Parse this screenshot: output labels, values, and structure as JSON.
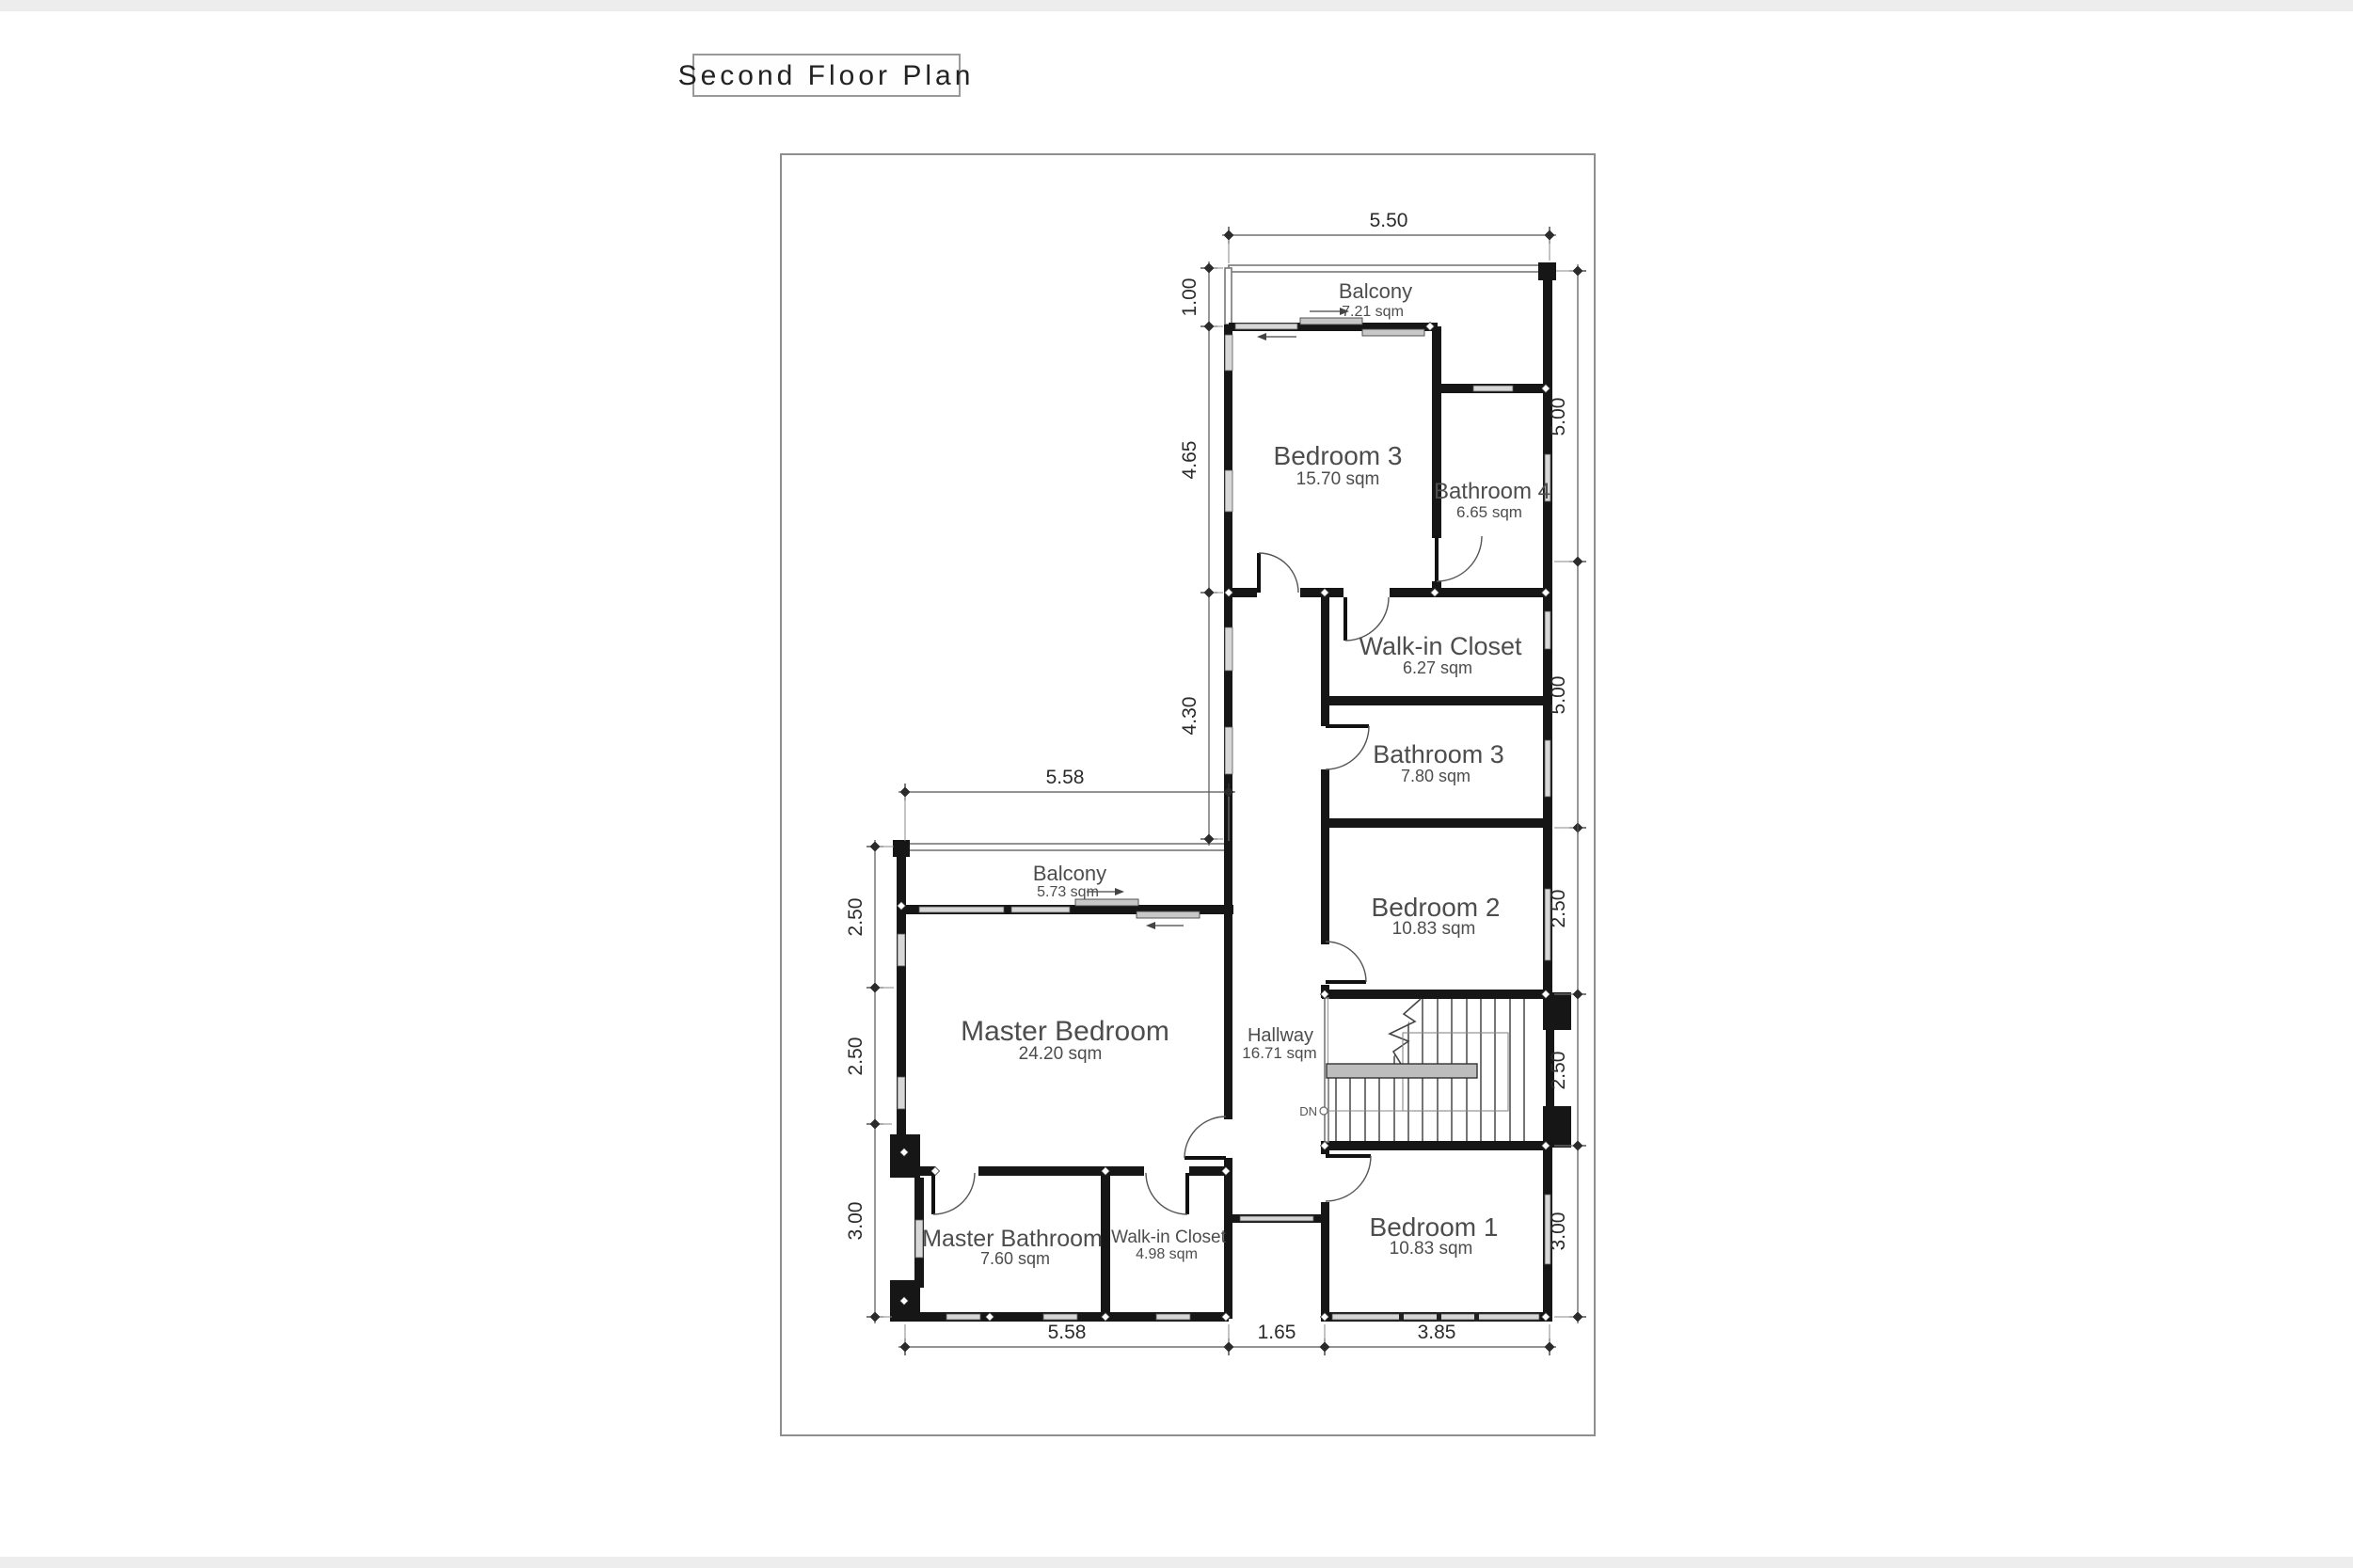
{
  "title": "Second Floor Plan",
  "rooms": {
    "balcony_upper": {
      "name": "Balcony",
      "area": "7.21 sqm"
    },
    "bedroom3": {
      "name": "Bedroom 3",
      "area": "15.70 sqm"
    },
    "bathroom4": {
      "name": "Bathroom 4",
      "area": "6.65 sqm"
    },
    "walkin_closet_upper": {
      "name": "Walk-in Closet",
      "area": "6.27 sqm"
    },
    "bathroom3": {
      "name": "Bathroom 3",
      "area": "7.80 sqm"
    },
    "bedroom2": {
      "name": "Bedroom 2",
      "area": "10.83 sqm"
    },
    "balcony_master": {
      "name": "Balcony",
      "area": "5.73 sqm"
    },
    "master_bedroom": {
      "name": "Master Bedroom",
      "area": "24.20 sqm"
    },
    "hallway": {
      "name": "Hallway",
      "area": "16.71 sqm"
    },
    "master_bathroom": {
      "name": "Master Bathroom",
      "area": "7.60 sqm"
    },
    "walkin_closet_lower": {
      "name": "Walk-in Closet",
      "area": "4.98 sqm"
    },
    "bedroom1": {
      "name": "Bedroom 1",
      "area": "10.83 sqm"
    }
  },
  "dimensions": {
    "top_width": "5.50",
    "upper_left": [
      "1.00",
      "4.65",
      "4.30"
    ],
    "upper_right": [
      "5.00",
      "5.00"
    ],
    "lower_left": [
      "2.50",
      "2.50",
      "3.00"
    ],
    "lower_right": [
      "2.50",
      "2.50",
      "3.00"
    ],
    "master_width": "5.58",
    "bottom": [
      "5.58",
      "1.65",
      "3.85"
    ]
  },
  "stairs": {
    "direction_label": "DN"
  },
  "colors": {
    "wall": "#161616",
    "dimension_line": "#555555",
    "room_label": "#4d4d4d"
  }
}
